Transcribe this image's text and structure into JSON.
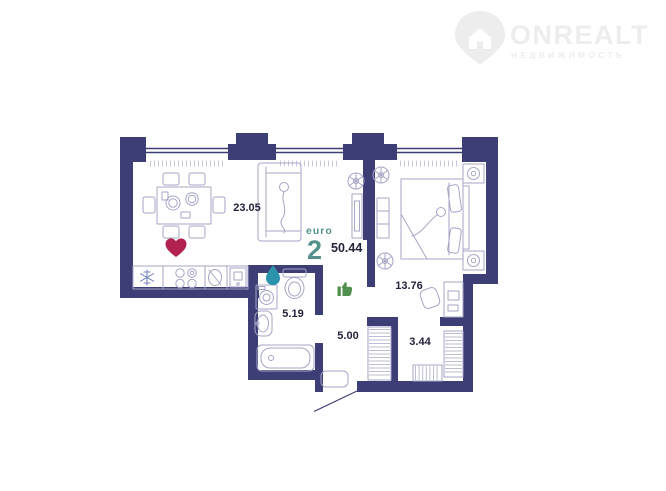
{
  "logo": {
    "brand": "ONREALT",
    "tagline": "НЕДВИЖИМОСТЬ",
    "icon": "location-pin-house-icon"
  },
  "plan": {
    "euro_label": "euro",
    "room_count": "2",
    "total_area": "50.44",
    "areas": {
      "living_kitchen": "23.05",
      "bedroom": "13.76",
      "bathroom": "5.19",
      "hallway": "5.00",
      "wardrobe": "3.44"
    },
    "icons": [
      "heart-icon",
      "water-drop-icon",
      "thumbs-up-icon",
      "snowflake-icon"
    ]
  },
  "colors": {
    "wall": "#3e3e76",
    "furniture": "#a5a5c6",
    "hatch": "#bcbcd6",
    "sill": "#c9c9de",
    "label": "#23233b",
    "teal": "#54908c",
    "heart": "#b2224f",
    "drop": "#2b93ab",
    "thumb": "#50904c",
    "snowflake": "#7787be",
    "logo": "#ededed"
  }
}
